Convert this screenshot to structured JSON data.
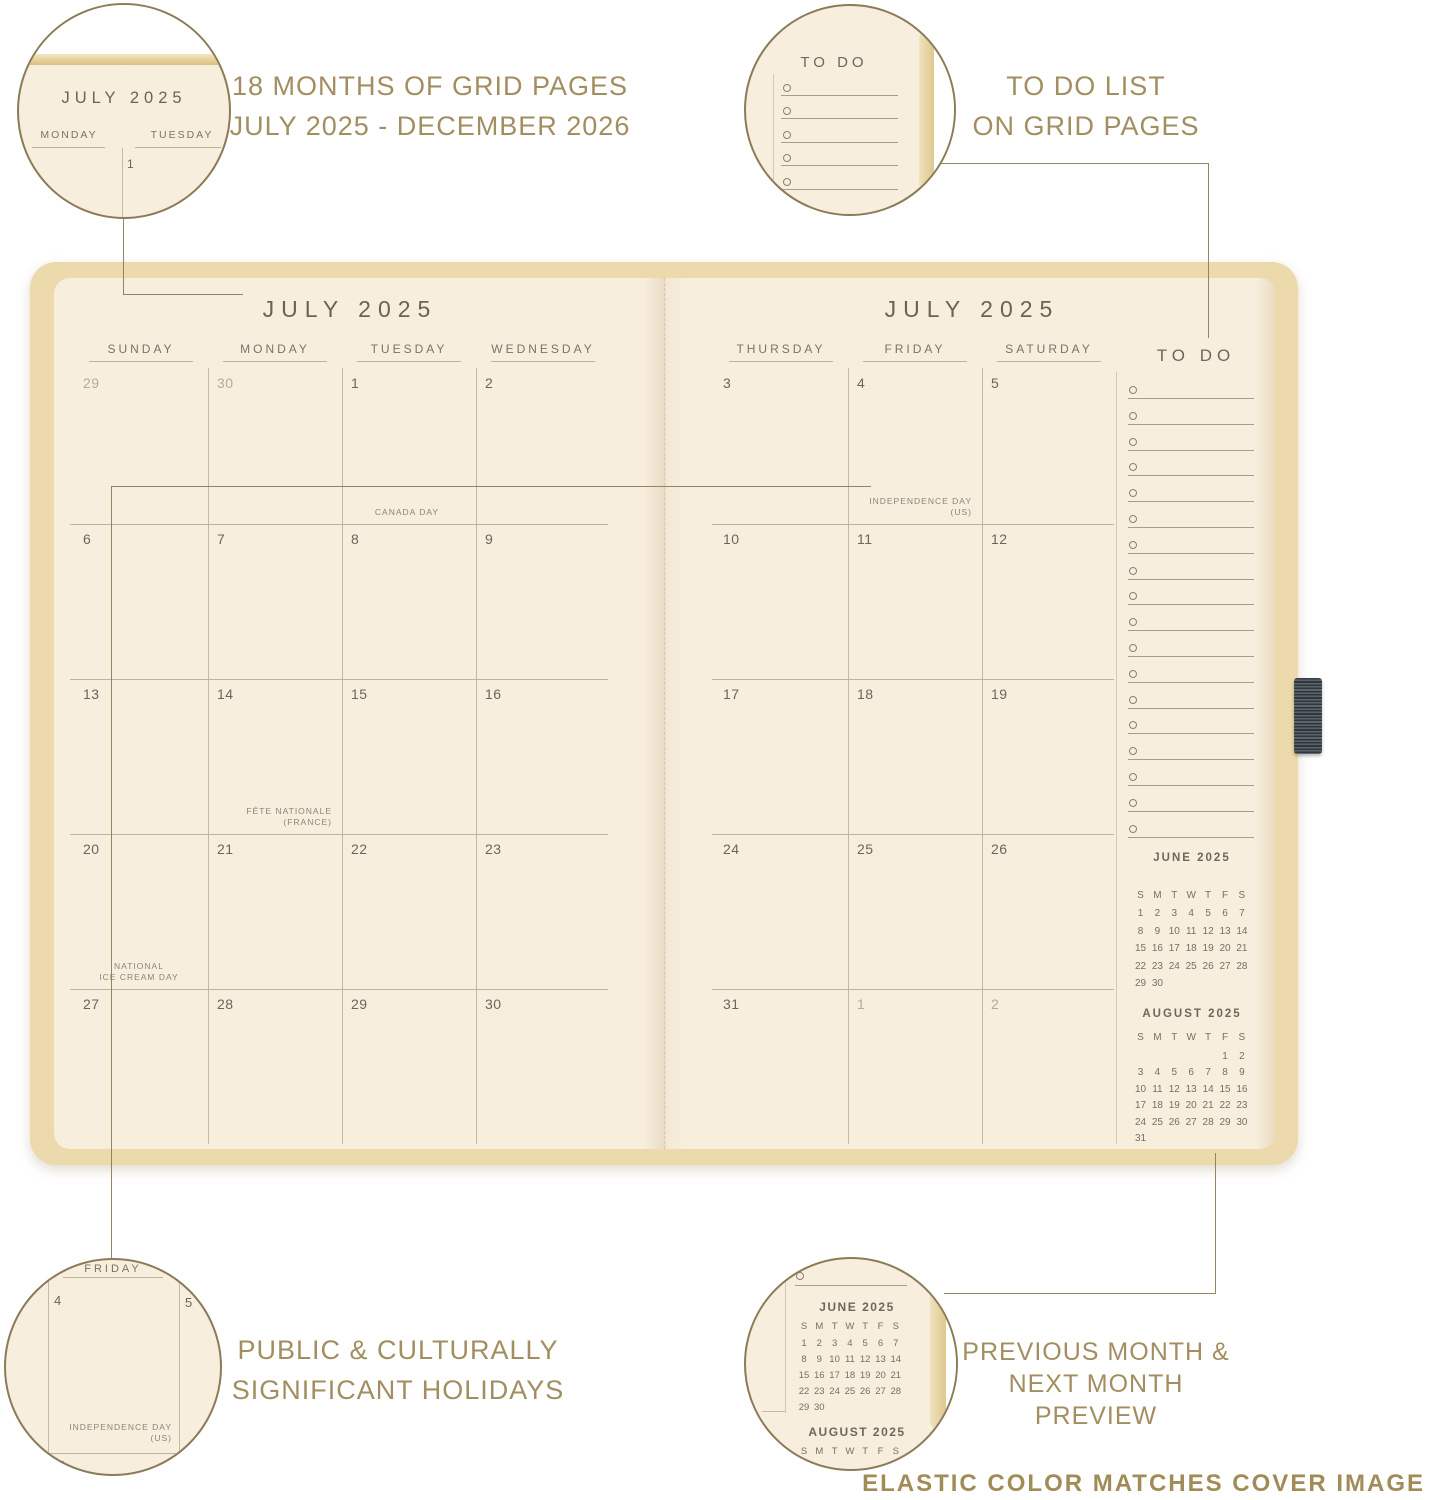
{
  "colors": {
    "background": "#ffffff",
    "page_cream": "#f8eede",
    "cover_tan": "#ecd9ac",
    "gold_text": "#a28e60",
    "line_gold": "#8b7b57",
    "grid_line": "#c6b99d",
    "date_text": "#6c655a",
    "date_muted": "#b5ab97",
    "elastic_dark": "#2f3639"
  },
  "callout_labels": {
    "top_left_line1": "18 MONTHS OF GRID PAGES",
    "top_left_line2": "JULY 2025 - DECEMBER 2026",
    "top_right_line1": "TO DO LIST",
    "top_right_line2": "ON GRID PAGES",
    "bottom_left_line1": "PUBLIC & CULTURALLY",
    "bottom_left_line2": "SIGNIFICANT HOLIDAYS",
    "bottom_right_line1": "PREVIOUS MONTH &",
    "bottom_right_line2": "NEXT MONTH PREVIEW",
    "footer_note": "ELASTIC COLOR MATCHES COVER IMAGE"
  },
  "zoom_circles": {
    "top_left": {
      "month_title": "JULY 2025",
      "col_left": "MONDAY",
      "col_right": "TUESDAY",
      "date": "1"
    },
    "top_right": {
      "title": "TO DO",
      "item_count": 5
    },
    "bottom_left": {
      "day_header": "FRIDAY",
      "date_left": "4",
      "date_right": "5",
      "holiday_line1": "INDEPENDENCE DAY",
      "holiday_line2": "(US)",
      "date_bottom": "11"
    },
    "bottom_right": {
      "shows": "previous and next month mini calendars"
    }
  },
  "planner": {
    "left_page": {
      "title": "JULY 2025",
      "day_headers": [
        "SUNDAY",
        "MONDAY",
        "TUESDAY",
        "WEDNESDAY"
      ],
      "weeks": [
        [
          {
            "date": "29",
            "muted": true
          },
          {
            "date": "30",
            "muted": true
          },
          {
            "date": "1",
            "holiday": [
              "CANADA DAY"
            ],
            "holiday_align": "center"
          },
          {
            "date": "2"
          }
        ],
        [
          {
            "date": "6"
          },
          {
            "date": "7"
          },
          {
            "date": "8"
          },
          {
            "date": "9"
          }
        ],
        [
          {
            "date": "13"
          },
          {
            "date": "14",
            "holiday": [
              "FÊTE NATIONALE",
              "(FRANCE)"
            ],
            "holiday_align": "right"
          },
          {
            "date": "15"
          },
          {
            "date": "16"
          }
        ],
        [
          {
            "date": "20",
            "holiday": [
              "NATIONAL",
              "ICE CREAM DAY"
            ],
            "holiday_align": "center"
          },
          {
            "date": "21"
          },
          {
            "date": "22"
          },
          {
            "date": "23"
          }
        ],
        [
          {
            "date": "27"
          },
          {
            "date": "28"
          },
          {
            "date": "29"
          },
          {
            "date": "30"
          }
        ]
      ]
    },
    "right_page": {
      "title": "JULY 2025",
      "day_headers": [
        "THURSDAY",
        "FRIDAY",
        "SATURDAY"
      ],
      "weeks": [
        [
          {
            "date": "3"
          },
          {
            "date": "4",
            "holiday": [
              "INDEPENDENCE DAY",
              "(US)"
            ],
            "holiday_align": "right"
          },
          {
            "date": "5"
          }
        ],
        [
          {
            "date": "10"
          },
          {
            "date": "11"
          },
          {
            "date": "12"
          }
        ],
        [
          {
            "date": "17"
          },
          {
            "date": "18"
          },
          {
            "date": "19"
          }
        ],
        [
          {
            "date": "24"
          },
          {
            "date": "25"
          },
          {
            "date": "26"
          }
        ],
        [
          {
            "date": "31"
          },
          {
            "date": "1",
            "muted": true
          },
          {
            "date": "2",
            "muted": true
          }
        ]
      ]
    },
    "todo": {
      "title": "TO DO",
      "item_count": 18
    },
    "mini_calendars": [
      {
        "title": "JUNE 2025",
        "weekday_header": [
          "S",
          "M",
          "T",
          "W",
          "T",
          "F",
          "S"
        ],
        "weeks": [
          [
            "1",
            "2",
            "3",
            "4",
            "5",
            "6",
            "7"
          ],
          [
            "8",
            "9",
            "10",
            "11",
            "12",
            "13",
            "14"
          ],
          [
            "15",
            "16",
            "17",
            "18",
            "19",
            "20",
            "21"
          ],
          [
            "22",
            "23",
            "24",
            "25",
            "26",
            "27",
            "28"
          ],
          [
            "29",
            "30",
            "",
            "",
            "",
            "",
            ""
          ]
        ]
      },
      {
        "title": "AUGUST 2025",
        "weekday_header": [
          "S",
          "M",
          "T",
          "W",
          "T",
          "F",
          "S"
        ],
        "weeks": [
          [
            "",
            "",
            "",
            "",
            "",
            "1",
            "2"
          ],
          [
            "3",
            "4",
            "5",
            "6",
            "7",
            "8",
            "9"
          ],
          [
            "10",
            "11",
            "12",
            "13",
            "14",
            "15",
            "16"
          ],
          [
            "17",
            "18",
            "19",
            "20",
            "21",
            "22",
            "23"
          ],
          [
            "24",
            "25",
            "26",
            "27",
            "28",
            "29",
            "30"
          ],
          [
            "31",
            "",
            "",
            "",
            "",
            "",
            ""
          ]
        ]
      }
    ]
  }
}
